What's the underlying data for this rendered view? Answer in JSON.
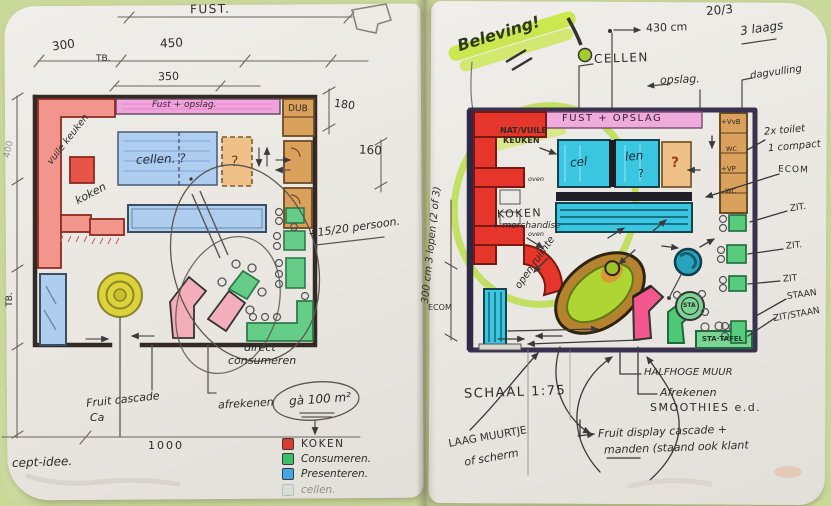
{
  "palette": {
    "mat_green": "#dce8ae",
    "paper": "#ece9e4",
    "wall_left": "#332a24",
    "wall_right": "#3a3150",
    "red": "#E6352A",
    "red_light": "#F2958C",
    "pink_band": "#F0A3DC",
    "blue": "#AECDEF",
    "cyan": "#3AC6E0",
    "orange": "#EFC189",
    "brown": "#D9A15C",
    "green": "#57CB7E",
    "yellow": "#DCD33A",
    "lime_highlight": "#C8E63F",
    "magenta": "#F2578D",
    "teal_ball": "#2AA3BF"
  },
  "left_page": {
    "dims": {
      "top_label": "FUST.",
      "d300": "300",
      "d450": "450",
      "tb": "TB.",
      "d350": "350",
      "d180": "180",
      "d160": "160",
      "d1000": "1000",
      "side_tb": "TB.",
      "side_400": "400"
    },
    "plan": {
      "band": "Fust + opslag.",
      "vuile_keuken": "vuile keuken",
      "koken": "koken",
      "cellen": "cellen. ?",
      "q_orange": "?",
      "dub": "DUB"
    },
    "notes": {
      "persons": "+15/20 persoon.",
      "direct_1": "direct'",
      "direct_2": "consumeren",
      "fruit_cascade": "Fruit cascade",
      "ca": "Ca",
      "afrekenen": "afrekenen",
      "area": "gà 100 m²",
      "concept": "cept-idee."
    },
    "legend": {
      "items": [
        {
          "label": "KOKEN",
          "color": "#E03A2E"
        },
        {
          "label": "Consumeren.",
          "color": "#3FBF6C"
        },
        {
          "label": "Presenteren.",
          "color": "#3FA8E8"
        },
        {
          "label": "cellen.",
          "color": "#9DD8C8"
        }
      ]
    }
  },
  "right_page": {
    "header": {
      "beleving": "Beleving!",
      "date": "20/3",
      "laags": "3 laags",
      "d430": "430 cm",
      "cellen": "CELLEN",
      "opslag": "opslag.",
      "dagvulling": "dagvulling"
    },
    "plan": {
      "band": "FUST + OPSLAG",
      "nat_vuile_1": "NAT/VUILE",
      "nat_vuile_2": "KEUKEN",
      "oven1": "oven",
      "oven2": "oven",
      "cel": "cel",
      "len": "len",
      "q_cyan": "?",
      "q_orange": "?",
      "koken": "KOKEN",
      "koken_sub": "+ merchandise",
      "open_ruimte": "open ruimte",
      "vvb": "+VvB",
      "wc1": "WC",
      "vp": "+VP",
      "wc2": "WC",
      "sta": "STA",
      "sta_tafel": "STA·TAFEL",
      "ecom_left": "ECOM"
    },
    "notes": {
      "toilets_1": "2x toilet",
      "toilets_2": "1 compact",
      "ecom": "ECOM",
      "zit1": "ZIT.",
      "zit2": "ZIT.",
      "zit3": "ZIT",
      "staan": "STAAN",
      "zit_staan": "ZIT/STAAN",
      "halfhoge_muur": "HALFHOGE MUUR",
      "afrekenen": "Afrekenen",
      "smoothies": "SMOOTHIES e.d.",
      "fruit_display_1": "Fruit display cascade +",
      "fruit_display_2": "manden (staand ook klant",
      "schaal": "SCHAAL 1:75",
      "laag_muurtje_1": "LAAG MUURTJE",
      "laag_muurtje_2": "of scherm",
      "lopen": "300 cm 3 lopen (2 of 3)"
    }
  }
}
